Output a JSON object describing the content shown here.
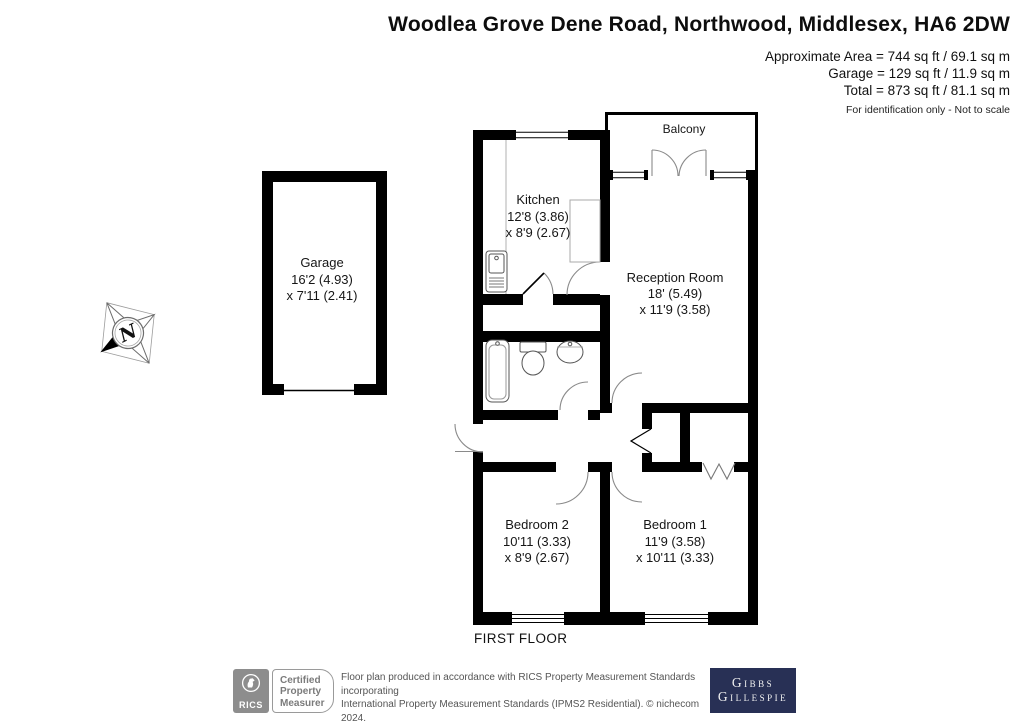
{
  "header": {
    "title": "Woodlea Grove Dene Road, Northwood, Middlesex, HA6 2DW",
    "area_line1": "Approximate Area = 744 sq ft / 69.1 sq m",
    "area_line2": "Garage = 129 sq ft / 11.9 sq m",
    "area_line3": "Total = 873 sq ft / 81.1 sq m",
    "note": "For identification only - Not to scale"
  },
  "plan": {
    "floor_label": "FIRST FLOOR",
    "compass_letter": "N",
    "rooms": {
      "balcony": {
        "name": "Balcony"
      },
      "kitchen": {
        "name": "Kitchen",
        "dims1": "12'8 (3.86)",
        "dims2": "x 8'9 (2.67)"
      },
      "reception": {
        "name": "Reception Room",
        "dims1": "18' (5.49)",
        "dims2": "x 11'9 (3.58)"
      },
      "garage": {
        "name": "Garage",
        "dims1": "16'2 (4.93)",
        "dims2": "x 7'11 (2.41)"
      },
      "bedroom2": {
        "name": "Bedroom 2",
        "dims1": "10'11 (3.33)",
        "dims2": "x 8'9 (2.67)"
      },
      "bedroom1": {
        "name": "Bedroom 1",
        "dims1": "11'9 (3.58)",
        "dims2": "x 10'11 (3.33)"
      }
    }
  },
  "footer": {
    "rics_brand": "RICS",
    "cert_lines": [
      "Certified",
      "Property",
      "Measurer"
    ],
    "disclaimer_lines": [
      "Floor plan produced in accordance with RICS Property Measurement Standards incorporating",
      "International Property Measurement Standards (IPMS2 Residential).  © nichecom 2024.",
      "Produced for Gibbs Gillespie.  REF: 1074672"
    ],
    "brand_line1": "Gibbs",
    "brand_line2": "Gillespie"
  },
  "colors": {
    "wall": "#000000",
    "brand_navy": "#283055",
    "rics_gray": "#8d8d8d",
    "footer_text": "#555555"
  }
}
